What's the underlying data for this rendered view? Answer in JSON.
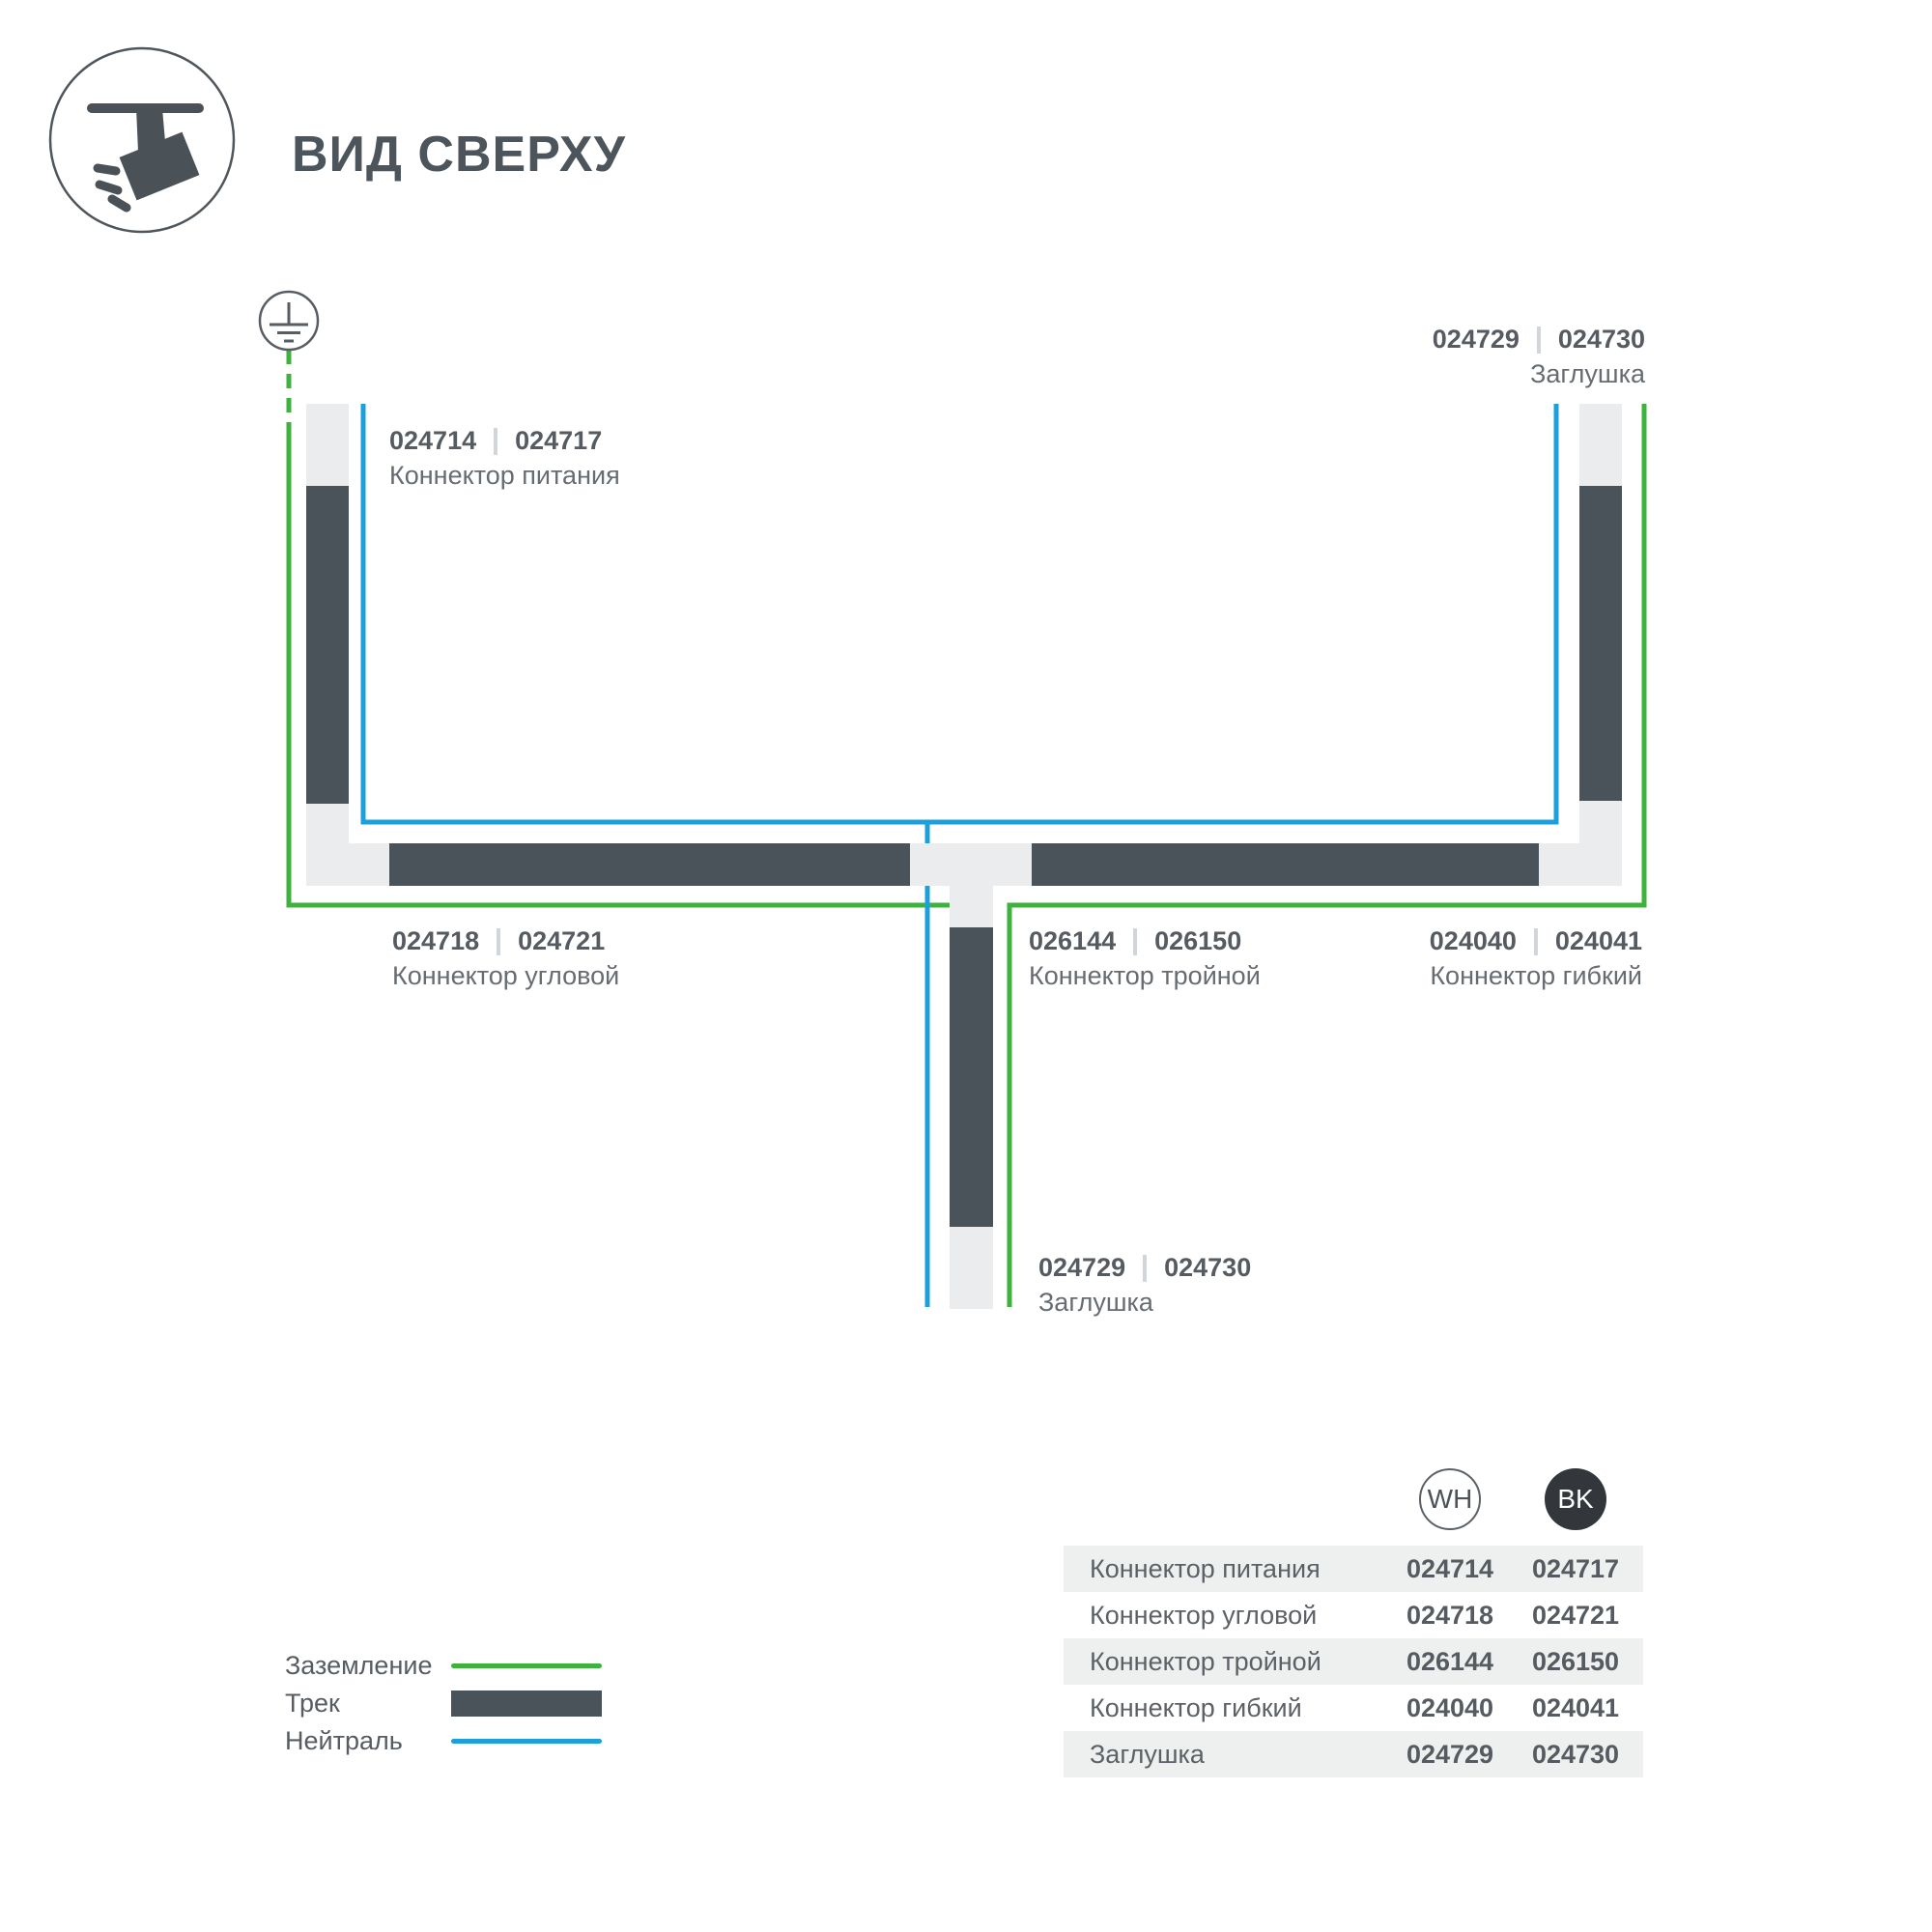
{
  "header": {
    "title": "ВИД СВЕРХУ"
  },
  "colors": {
    "track": "#4a525a",
    "rail": "#ebeced",
    "ground_green": "#3db23c",
    "neutral_blue": "#1c9fda",
    "text_dark": "#555b61",
    "text_muted": "#666c72",
    "row_bg": "#eeefef",
    "bk_circle": "#33373b"
  },
  "icons": {
    "header": "track-spotlight-top-view-icon",
    "diagram": "earth-ground-icon"
  },
  "diagram": {
    "labels": {
      "power": {
        "codes": [
          "024714",
          "024717"
        ],
        "name": "Коннектор питания"
      },
      "endcap_top": {
        "codes": [
          "024729",
          "024730"
        ],
        "name": "Заглушка"
      },
      "corner": {
        "codes": [
          "024718",
          "024721"
        ],
        "name": "Коннектор угловой"
      },
      "triple": {
        "codes": [
          "026144",
          "026150"
        ],
        "name": "Коннектор тройной"
      },
      "flexible": {
        "codes": [
          "024040",
          "024041"
        ],
        "name": "Коннектор гибкий"
      },
      "endcap_bottom": {
        "codes": [
          "024729",
          "024730"
        ],
        "name": "Заглушка"
      }
    }
  },
  "legend": {
    "items": [
      {
        "label": "Заземление",
        "swatch": "ground"
      },
      {
        "label": "Трек",
        "swatch": "track"
      },
      {
        "label": "Нейтраль",
        "swatch": "neutral"
      }
    ]
  },
  "table": {
    "columns": [
      {
        "id": "WH"
      },
      {
        "id": "BK"
      }
    ],
    "rows": [
      {
        "name": "Коннектор питания",
        "wh": "024714",
        "bk": "024717"
      },
      {
        "name": "Коннектор угловой",
        "wh": "024718",
        "bk": "024721"
      },
      {
        "name": "Коннектор тройной",
        "wh": "026144",
        "bk": "026150"
      },
      {
        "name": "Коннектор гибкий",
        "wh": "024040",
        "bk": "024041"
      },
      {
        "name": "Заглушка",
        "wh": "024729",
        "bk": "024730"
      }
    ]
  }
}
